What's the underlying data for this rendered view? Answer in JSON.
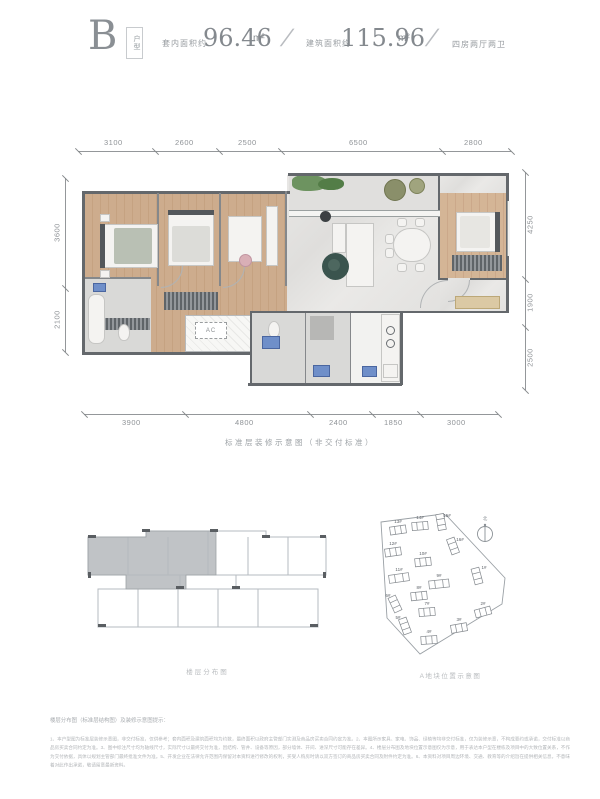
{
  "header": {
    "unit_letter": "B",
    "unit_tag": "户型",
    "indoor_area_label": "套内面积约",
    "indoor_area_value": "96.46",
    "indoor_area_unit": "m²",
    "separator": "/",
    "build_area_label": "建筑面积约",
    "build_area_value": "115.96",
    "build_area_unit": "m²",
    "layout_desc": "四房两厅两卫"
  },
  "floor_plan": {
    "caption": "标准层装修示意图（非交付标准）",
    "ac_label": "AC",
    "dimensions": {
      "top": [
        "3100",
        "2600",
        "2500",
        "6500",
        "2800"
      ],
      "bottom": [
        "3900",
        "4800",
        "2400",
        "1850",
        "3000"
      ],
      "left": [
        "3600",
        "2100"
      ],
      "right": [
        "4250",
        "1900",
        "2500"
      ]
    }
  },
  "floor_diagram": {
    "caption": "楼层分布图"
  },
  "site_plan": {
    "caption": "A地块位置示意图",
    "compass_label": "北",
    "buildings": [
      {
        "label": "13#"
      },
      {
        "label": "14#"
      },
      {
        "label": "15#"
      },
      {
        "label": "16#"
      },
      {
        "label": "12#"
      },
      {
        "label": "10#"
      },
      {
        "label": "11#"
      },
      {
        "label": "9#"
      },
      {
        "label": "8#"
      },
      {
        "label": "1#"
      },
      {
        "label": "6#"
      },
      {
        "label": "7#"
      },
      {
        "label": "5#"
      },
      {
        "label": "4#"
      },
      {
        "label": "3#"
      },
      {
        "label": "2#"
      }
    ]
  },
  "disclaimer": {
    "title": "楼层分布图（标准层结构图）及装修示意图提示：",
    "body": "1、本户型图为标准层装修示意图，非交付标准，仅供参考；套内面积及建筑面积均为约数，最终面积以政府主管部门实测及商品房买卖合同约定为准。2、本图所示家具、家电、饰品、绿植等均非交付标准，仅为装修示意，不构成要约或承诺，交付标准以商品房买卖合同约定为准。3、图中标注尺寸均为轴线尺寸，实际尺寸以最终交付为准，因结构、管井、设备等原因，部分墙体、开间、进深尺寸可能存在差异。4、楼层分布图及地块位置示意图仅为示意，用于表达本户型在楼栋及项目中的大致位置关系，不作为交付依据，具体以规划主管部门最终批准文件为准。5、开发企业在法律允许范围内保留对本资料进行修改的权利，买受人购房时请以双方签订的商品房买卖合同及附件约定为准。6、本资料对项目周边环境、交通、教育等的介绍旨在提供相关信息，不意味着对此作出承诺，敬请留意最新资料。"
  }
}
